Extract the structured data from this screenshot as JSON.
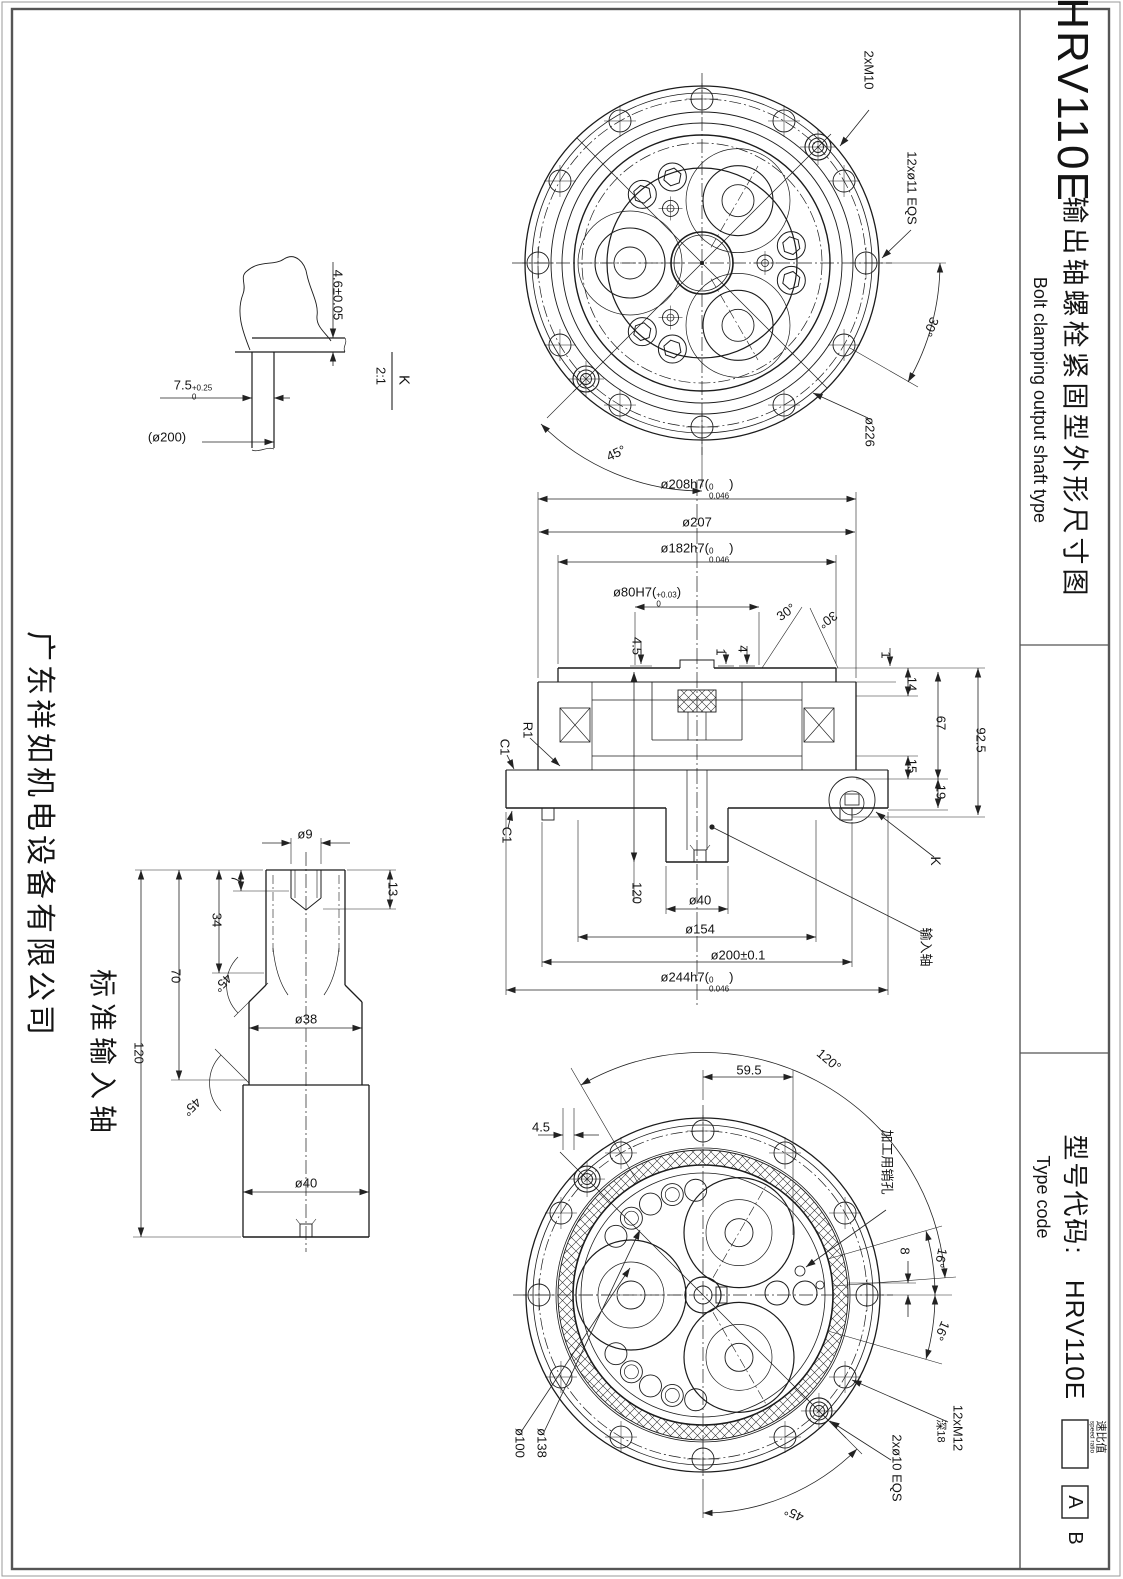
{
  "frame": {
    "model": "HRV110E",
    "title_cn": "输出轴螺栓紧固型外形尺寸图",
    "title_en": "Bolt clamping output shaft type",
    "type_code_cn": "型号代码:",
    "type_code_en": "Type code",
    "code_model": "HRV110E",
    "ratio_cn": "速比值",
    "ratio_en": "speed ratio",
    "suffix_a": "A",
    "suffix_b": "B"
  },
  "company": "广东祥如机电设备有限公司",
  "input_shaft_label": "标准输入轴",
  "labels": [
    {
      "t": "2xM10",
      "x": 869,
      "y": 70,
      "r": 90
    },
    {
      "t": "12xø11 EQS",
      "x": 912,
      "y": 188,
      "r": 90
    },
    {
      "t": "30°",
      "x": 931,
      "y": 327,
      "r": 115
    },
    {
      "t": "ø226",
      "x": 870,
      "y": 432,
      "r": 90
    },
    {
      "t": "45°",
      "x": 616,
      "y": 453,
      "r": -25
    },
    {
      "t": "4.6±0.05",
      "x": 338,
      "y": 295,
      "r": 90
    },
    {
      "t": "K",
      "x": 404,
      "y": 380,
      "r": 90,
      "s": 15
    },
    {
      "t": "2:1",
      "x": 381,
      "y": 376,
      "r": 90
    },
    {
      "t": "7.5",
      "sup": "+0.25",
      "sub": "0",
      "x": 193,
      "y": 390
    },
    {
      "t": "(ø200)",
      "x": 167,
      "y": 437
    },
    {
      "t": "ø208h7(",
      "sup": "0",
      "sub": "0.046",
      "post": ")",
      "x": 697,
      "y": 489
    },
    {
      "t": "ø207",
      "x": 697,
      "y": 522
    },
    {
      "t": "ø182h7(",
      "sup": "0",
      "sub": "0.046",
      "post": ")",
      "x": 697,
      "y": 553
    },
    {
      "t": "ø80H7(",
      "sup": "+0.03",
      "sub": "0",
      "post": ")",
      "x": 647,
      "y": 597
    },
    {
      "t": "30°",
      "x": 786,
      "y": 612,
      "r": -35
    },
    {
      "t": "30°",
      "x": 828,
      "y": 620,
      "r": 145
    },
    {
      "t": "4.5",
      "x": 637,
      "y": 646,
      "r": 90
    },
    {
      "t": "1",
      "x": 721,
      "y": 652,
      "r": 90
    },
    {
      "t": "4",
      "x": 743,
      "y": 649,
      "r": 90
    },
    {
      "t": "1",
      "x": 886,
      "y": 655,
      "r": 90
    },
    {
      "t": "14",
      "x": 912,
      "y": 684,
      "r": 90
    },
    {
      "t": "67",
      "x": 941,
      "y": 723,
      "r": 90
    },
    {
      "t": "92.5",
      "x": 981,
      "y": 740,
      "r": 90
    },
    {
      "t": "15",
      "x": 912,
      "y": 766,
      "r": 90
    },
    {
      "t": "19",
      "x": 941,
      "y": 792,
      "r": 90
    },
    {
      "t": "R1",
      "x": 528,
      "y": 730,
      "r": 90
    },
    {
      "t": "C1",
      "x": 505,
      "y": 747,
      "r": 90
    },
    {
      "t": "C1",
      "x": 507,
      "y": 835,
      "r": 90
    },
    {
      "t": "K",
      "x": 936,
      "y": 861,
      "r": 90,
      "s": 14
    },
    {
      "t": "输入轴",
      "x": 926,
      "y": 947,
      "r": 90
    },
    {
      "t": "120",
      "x": 637,
      "y": 893,
      "r": 90
    },
    {
      "t": "ø40",
      "x": 700,
      "y": 900
    },
    {
      "t": "ø154",
      "x": 700,
      "y": 929
    },
    {
      "t": "ø200±0.1",
      "x": 738,
      "y": 955
    },
    {
      "t": "ø244h7(",
      "sup": "0",
      "sub": "0.046",
      "post": ")",
      "x": 697,
      "y": 982
    },
    {
      "t": "ø9",
      "x": 305,
      "y": 834
    },
    {
      "t": "7",
      "x": 236,
      "y": 879,
      "r": 90
    },
    {
      "t": "13",
      "x": 393,
      "y": 889,
      "r": 90
    },
    {
      "t": "34",
      "x": 217,
      "y": 920,
      "r": 90
    },
    {
      "t": "70",
      "x": 176,
      "y": 976,
      "r": 90
    },
    {
      "t": "120",
      "x": 139,
      "y": 1053,
      "r": 90
    },
    {
      "t": "45°",
      "x": 223,
      "y": 983,
      "r": 135
    },
    {
      "t": "45°",
      "x": 192,
      "y": 1107,
      "r": 135
    },
    {
      "t": "ø38",
      "x": 306,
      "y": 1019
    },
    {
      "t": "ø40",
      "x": 306,
      "y": 1183
    },
    {
      "t": "59.5",
      "x": 749,
      "y": 1070
    },
    {
      "t": "4.5",
      "x": 541,
      "y": 1127
    },
    {
      "t": "120°",
      "x": 829,
      "y": 1060,
      "r": 40
    },
    {
      "t": "加工用销孔",
      "x": 887,
      "y": 1162,
      "r": 90
    },
    {
      "t": "8",
      "x": 905,
      "y": 1251,
      "r": 90
    },
    {
      "t": "16°",
      "x": 941,
      "y": 1258,
      "r": 102
    },
    {
      "t": "16°",
      "x": 942,
      "y": 1331,
      "r": 114
    },
    {
      "t": "12xM12",
      "x": 958,
      "y": 1428,
      "r": 90
    },
    {
      "t": "深18",
      "x": 940,
      "y": 1431,
      "r": 90,
      "s": 11
    },
    {
      "t": "2xø10 EQS",
      "x": 897,
      "y": 1468,
      "r": 90
    },
    {
      "t": "ø138",
      "x": 542,
      "y": 1443,
      "r": 90
    },
    {
      "t": "ø100",
      "x": 520,
      "y": 1443,
      "r": 90
    },
    {
      "t": "45°",
      "x": 794,
      "y": 1514,
      "r": -155
    }
  ]
}
